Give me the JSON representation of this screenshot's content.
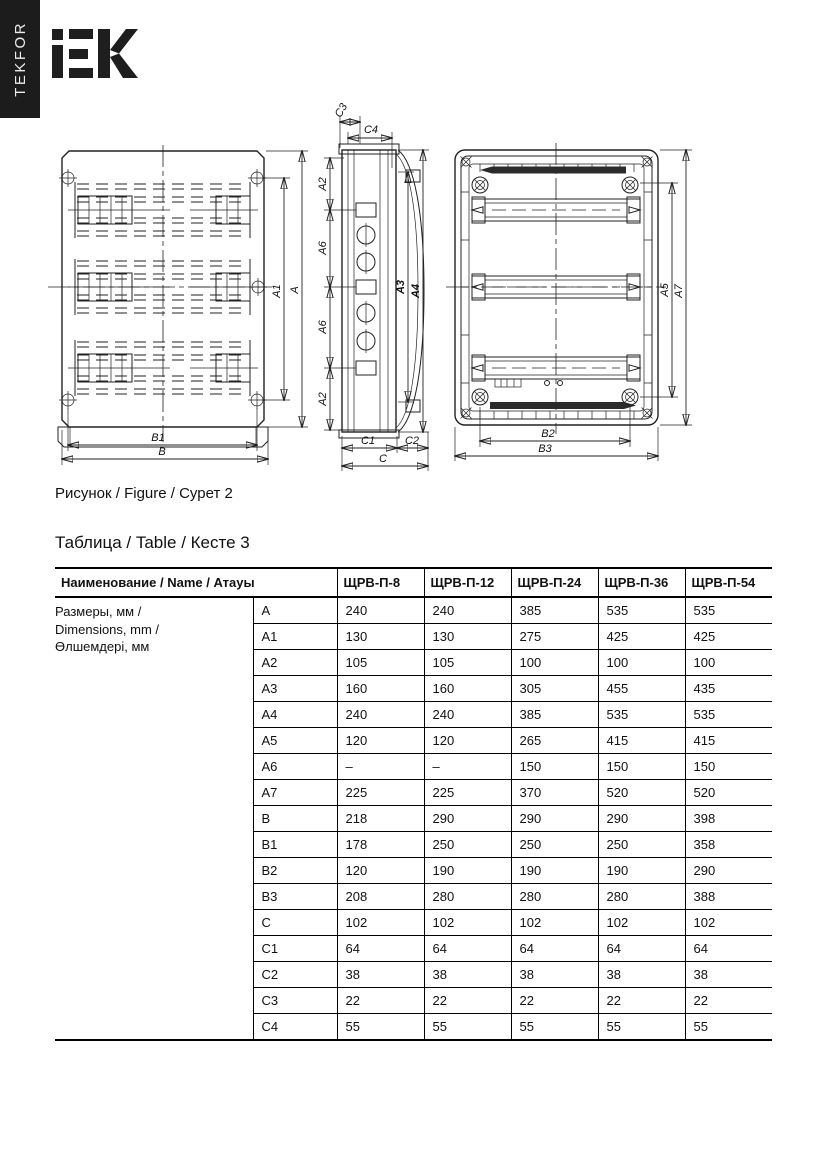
{
  "brand": {
    "vertical_text": "TEKFOR",
    "logo_alt": "IEK"
  },
  "figure": {
    "caption": "Рисунок / Figure / Сурет 2",
    "labels": {
      "A": "A",
      "A1": "A1",
      "A2": "A2",
      "A3": "A3",
      "A4": "A4",
      "A5": "A5",
      "A6": "A6",
      "A7": "A7",
      "B": "B",
      "B1": "B1",
      "B2": "B2",
      "B3": "B3",
      "C": "C",
      "C1": "C1",
      "C2": "C2",
      "C3": "C3",
      "C4": "C4"
    }
  },
  "table": {
    "title": "Таблица / Table / Кесте 3",
    "header_name": "Наименование / Name / Атауы",
    "models": [
      "ЩРВ-П-8",
      "ЩРВ-П-12",
      "ЩРВ-П-24",
      "ЩРВ-П-36",
      "ЩРВ-П-54"
    ],
    "group_label_lines": [
      "Размеры, мм /",
      "Dimensions, mm /",
      "Өлшемдері, мм"
    ],
    "rows": [
      {
        "name": "A",
        "values": [
          "240",
          "240",
          "385",
          "535",
          "535"
        ]
      },
      {
        "name": "A1",
        "values": [
          "130",
          "130",
          "275",
          "425",
          "425"
        ]
      },
      {
        "name": "A2",
        "values": [
          "105",
          "105",
          "100",
          "100",
          "100"
        ]
      },
      {
        "name": "A3",
        "values": [
          "160",
          "160",
          "305",
          "455",
          "435"
        ]
      },
      {
        "name": "A4",
        "values": [
          "240",
          "240",
          "385",
          "535",
          "535"
        ]
      },
      {
        "name": "A5",
        "values": [
          "120",
          "120",
          "265",
          "415",
          "415"
        ]
      },
      {
        "name": "A6",
        "values": [
          "–",
          "–",
          "150",
          "150",
          "150"
        ]
      },
      {
        "name": "A7",
        "values": [
          "225",
          "225",
          "370",
          "520",
          "520"
        ]
      },
      {
        "name": "B",
        "values": [
          "218",
          "290",
          "290",
          "290",
          "398"
        ]
      },
      {
        "name": "B1",
        "values": [
          "178",
          "250",
          "250",
          "250",
          "358"
        ]
      },
      {
        "name": "B2",
        "values": [
          "120",
          "190",
          "190",
          "190",
          "290"
        ]
      },
      {
        "name": "B3",
        "values": [
          "208",
          "280",
          "280",
          "280",
          "388"
        ]
      },
      {
        "name": "C",
        "values": [
          "102",
          "102",
          "102",
          "102",
          "102"
        ]
      },
      {
        "name": "C1",
        "values": [
          "64",
          "64",
          "64",
          "64",
          "64"
        ]
      },
      {
        "name": "C2",
        "values": [
          "38",
          "38",
          "38",
          "38",
          "38"
        ]
      },
      {
        "name": "C3",
        "values": [
          "22",
          "22",
          "22",
          "22",
          "22"
        ]
      },
      {
        "name": "C4",
        "values": [
          "55",
          "55",
          "55",
          "55",
          "55"
        ]
      }
    ]
  }
}
